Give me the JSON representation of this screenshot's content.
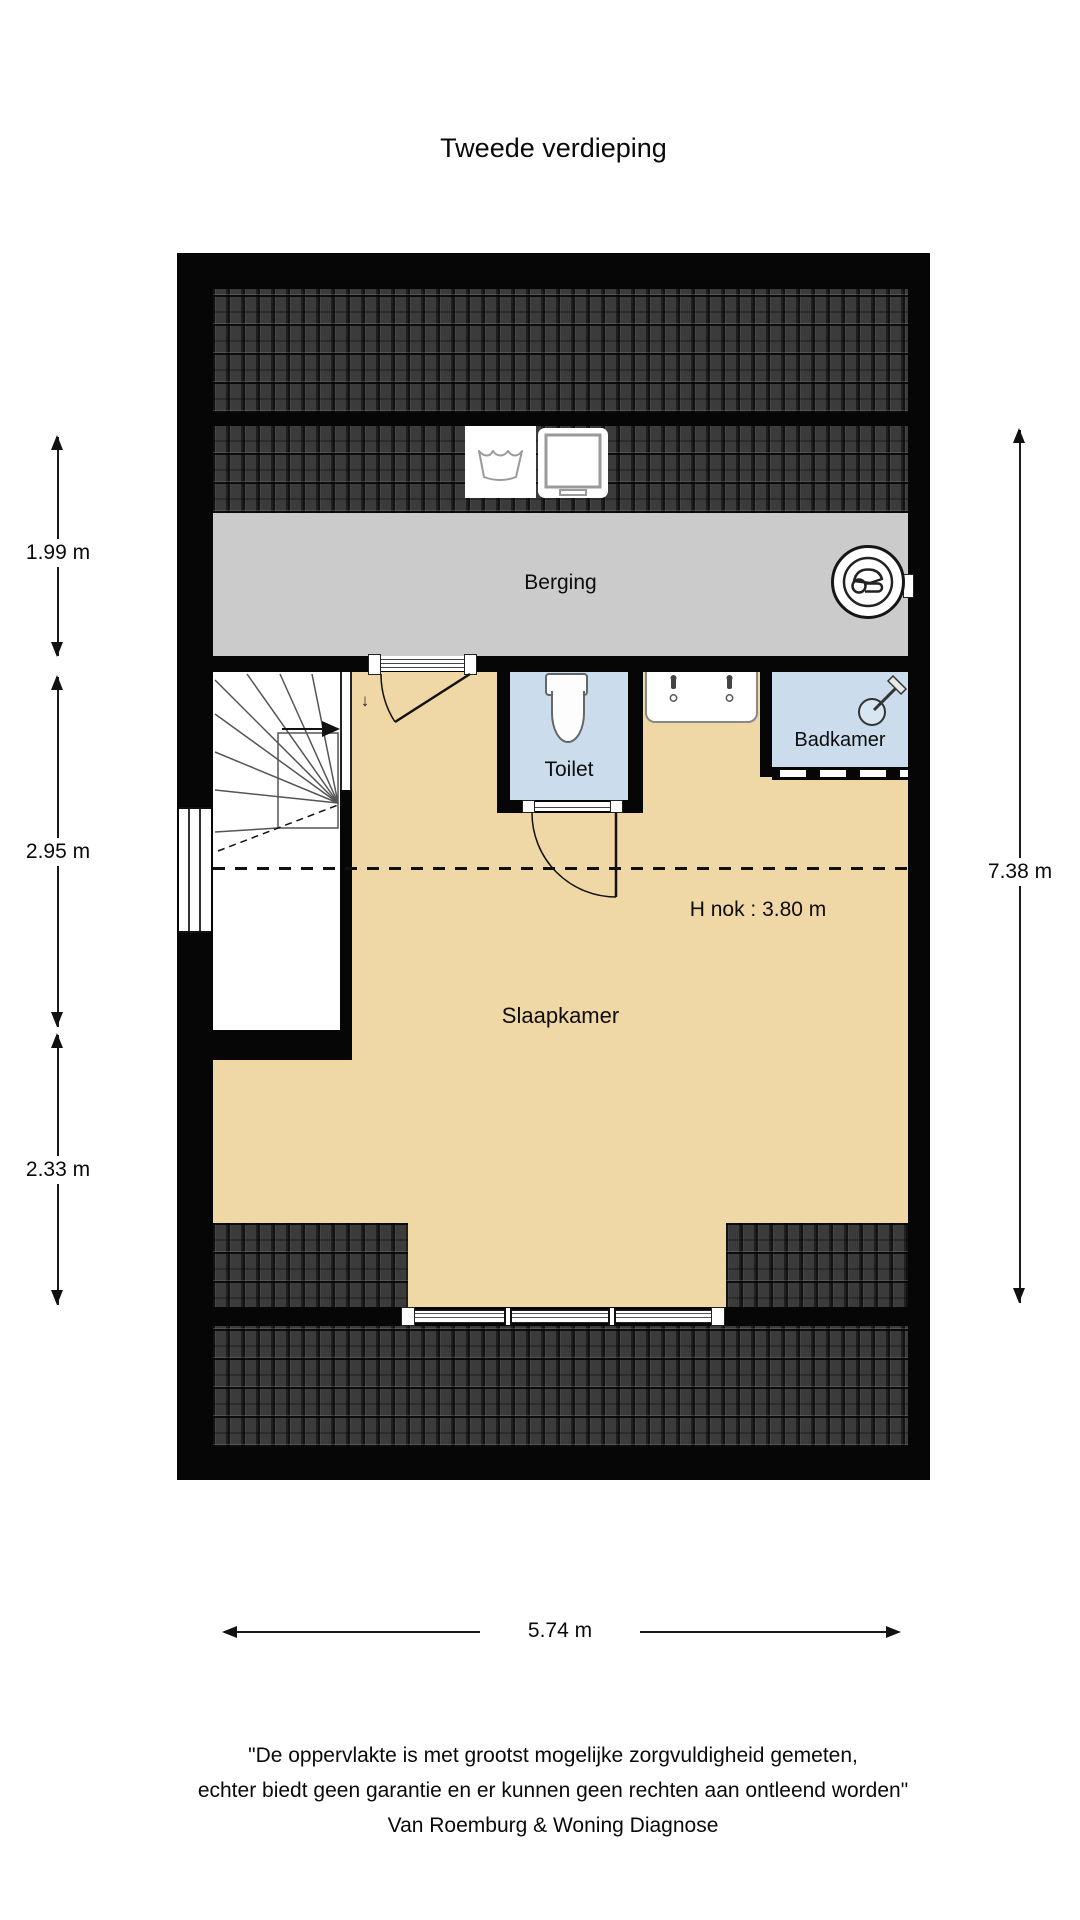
{
  "page": {
    "title": "Tweede verdieping"
  },
  "floorplan": {
    "rooms": {
      "berging": "Berging",
      "toilet": "Toilet",
      "badkamer": "Badkamer",
      "slaapkamer": "Slaapkamer"
    },
    "annotations": {
      "h_nok": "H nok : 3.80 m",
      "stair_direction": "↓"
    },
    "dimensions": {
      "left": [
        {
          "label": "1.99 m"
        },
        {
          "label": "2.95 m"
        },
        {
          "label": "2.33 m"
        }
      ],
      "right": {
        "label": "7.38 m"
      },
      "bottom": {
        "label": "5.74 m"
      }
    },
    "icons": {
      "washing_machine": "washing-machine-icon",
      "dryer": "dryer-icon",
      "mechanical_ventilation": "mechanical-ventilation-icon",
      "toilet_fixture": "toilet-icon",
      "taps": "tap-icon",
      "shower": "shower-icon",
      "stairs": "stairs-icon"
    },
    "colors": {
      "wall": "#060606",
      "roof": "#3b3b3b",
      "berging_floor": "#cbcbcb",
      "bedroom_floor": "#f0d7a6",
      "sanitary_floor": "#cbdcec"
    }
  },
  "footer": {
    "line1": "\"De oppervlakte is met grootst mogelijke zorgvuldigheid gemeten,",
    "line2": "echter biedt geen garantie en er kunnen geen rechten aan ontleend worden\"",
    "line3": "Van Roemburg & Woning Diagnose"
  }
}
